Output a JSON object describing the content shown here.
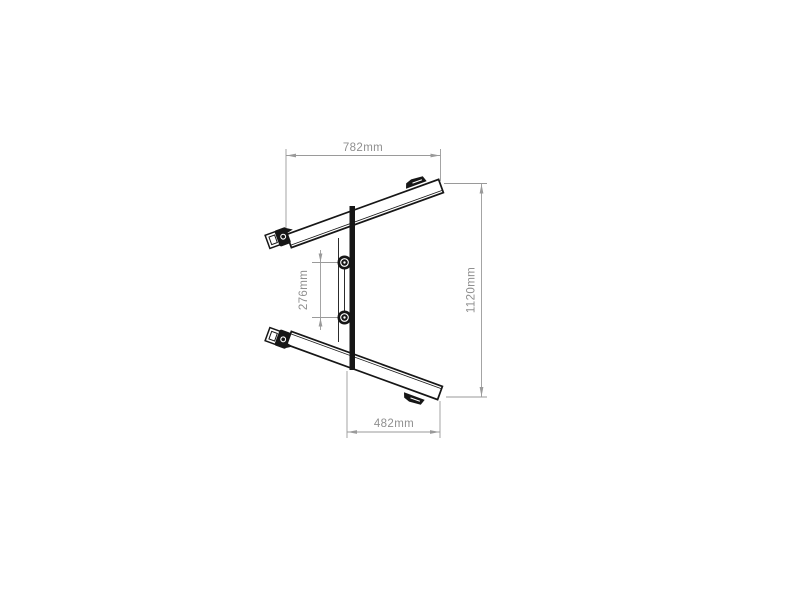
{
  "drawing": {
    "background_color": "#ffffff",
    "structure_color": "#161616",
    "dimension_color": "#9a9a9a",
    "dimensions": {
      "top_width": "782mm",
      "overall_height": "1120mm",
      "bracket_spacing": "276mm",
      "bottom_width": "482mm"
    }
  }
}
